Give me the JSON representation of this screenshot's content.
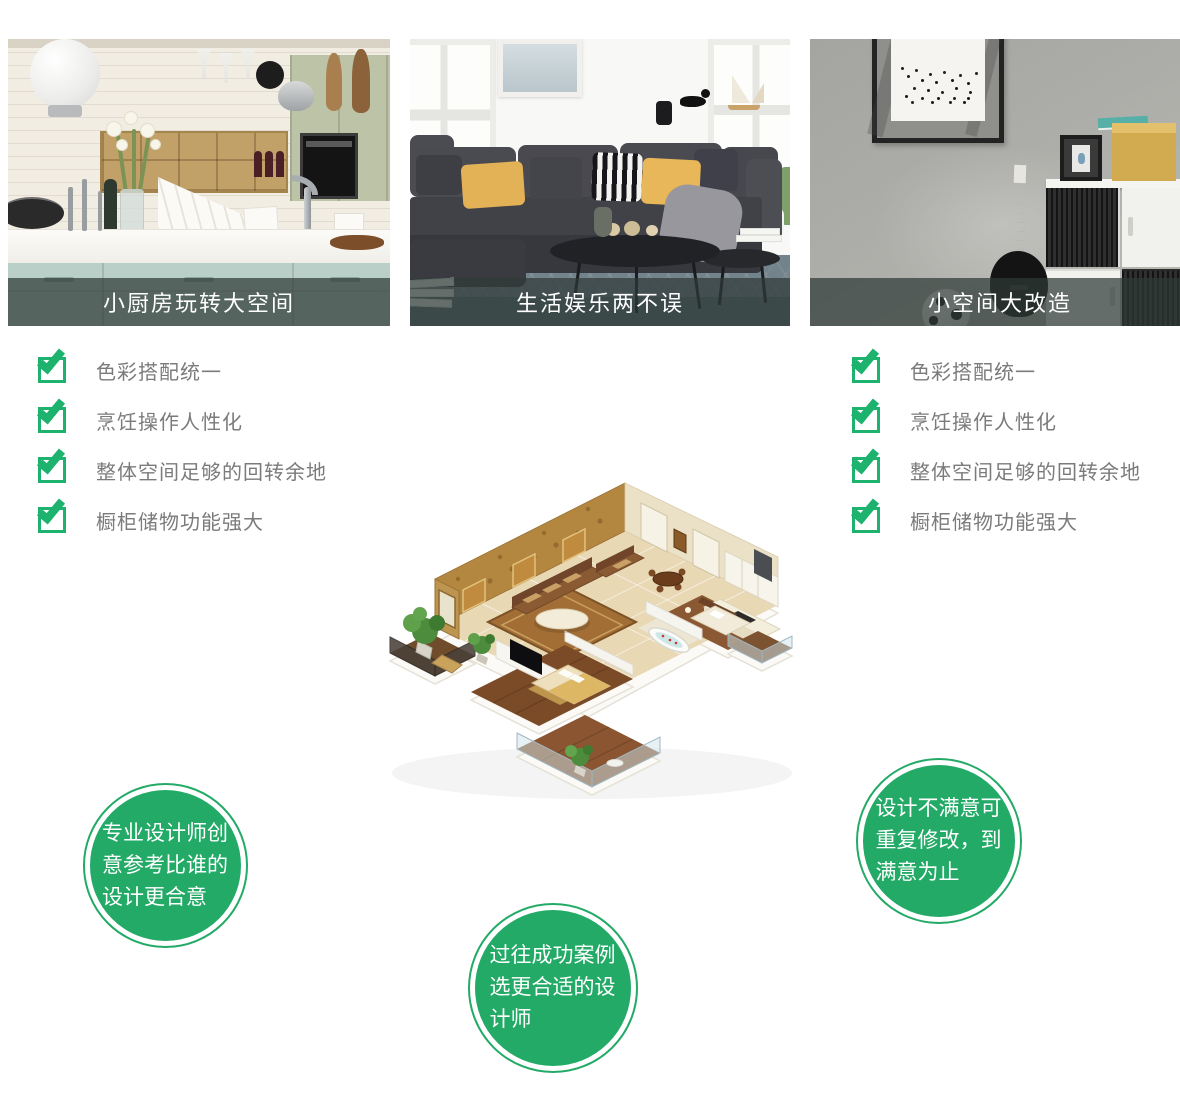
{
  "colors": {
    "green": "#23aa67",
    "check_green": "#1db26e",
    "caption_bar": "rgba(47,58,56,0.72)",
    "checklist_text": "#7b7b7b"
  },
  "cards": [
    {
      "caption": "小厨房玩转大空间"
    },
    {
      "caption": "生活娱乐两不误"
    },
    {
      "caption": "小空间大改造"
    }
  ],
  "checklists": {
    "left": {
      "items": [
        "色彩搭配统一",
        "烹饪操作人性化",
        "整体空间足够的回转余地",
        "橱柜储物功能强大"
      ]
    },
    "right": {
      "items": [
        "色彩搭配统一",
        "烹饪操作人性化",
        "整体空间足够的回转余地",
        "橱柜储物功能强大"
      ]
    }
  },
  "bubbles": {
    "left": {
      "text": "专业设计师创意参考比谁的设计更合意"
    },
    "center": {
      "text": "过往成功案例选更合适的设计师"
    },
    "right": {
      "text": "设计不满意可重复修改，到满意为止"
    }
  }
}
